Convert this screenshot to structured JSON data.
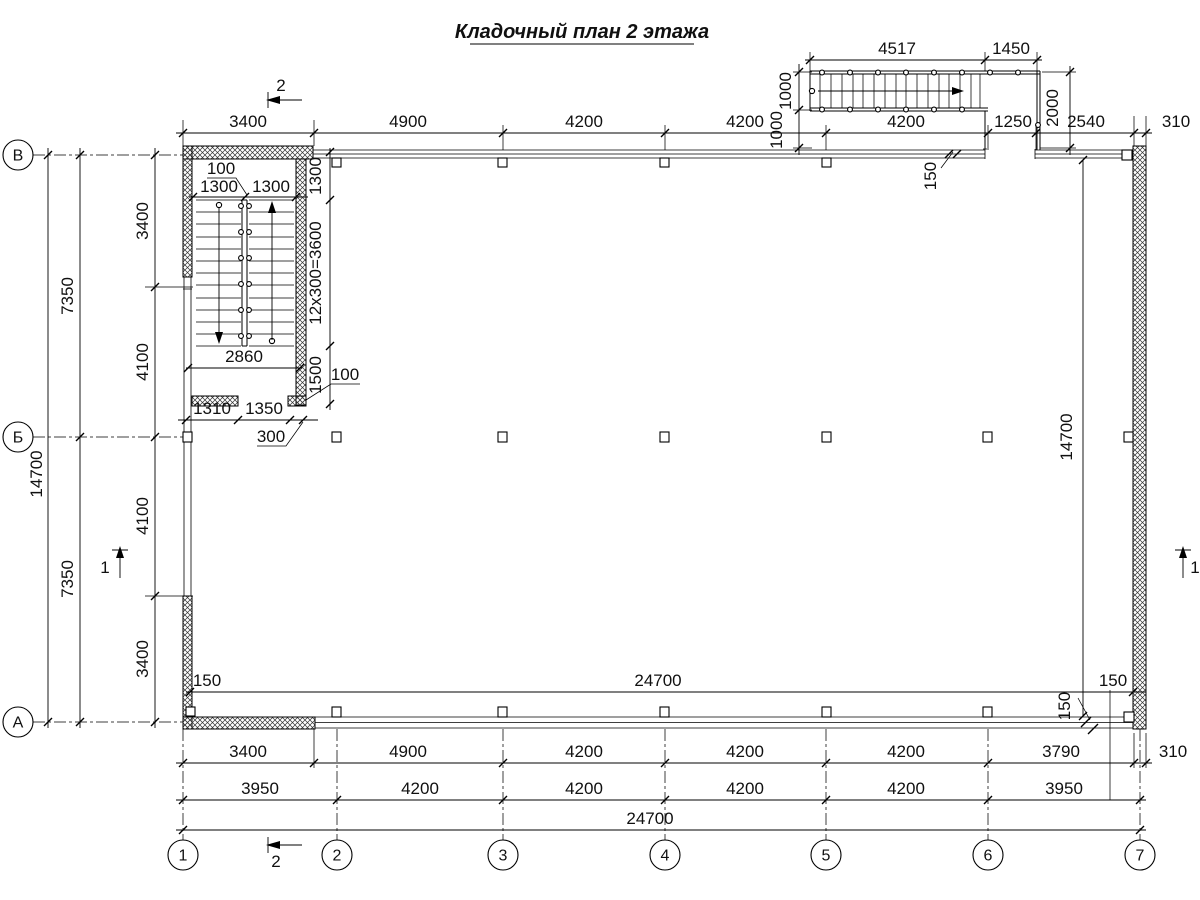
{
  "title": "Кладочный план 2 этажа",
  "axes": {
    "letters": [
      "В",
      "Б",
      "А"
    ],
    "numbers": [
      "1",
      "2",
      "3",
      "4",
      "5",
      "6",
      "7"
    ]
  },
  "sections": {
    "mark1": "1",
    "mark2": "2"
  },
  "dims": {
    "top": [
      "3400",
      "4900",
      "4200",
      "4200",
      "4200",
      "1250",
      "2540",
      "310"
    ],
    "ext_stair": [
      "4517",
      "1450",
      "1000",
      "1000",
      "2000",
      "150"
    ],
    "stairwell": [
      "100",
      "1300",
      "1300",
      "1300",
      "12x300=3600",
      "1500",
      "2860",
      "100",
      "1310",
      "1350",
      "300"
    ],
    "left_col": [
      "14700",
      "7350",
      "7350",
      "3400",
      "4100",
      "4100",
      "3400"
    ],
    "right_col": [
      "14700",
      "150"
    ],
    "inner_bottom": [
      "150",
      "24700",
      "150"
    ],
    "bottom_row1": [
      "3400",
      "4900",
      "4200",
      "4200",
      "4200",
      "3790",
      "310"
    ],
    "bottom_row2": [
      "3950",
      "4200",
      "4200",
      "4200",
      "4200",
      "3950"
    ],
    "bottom_total": "24700"
  }
}
